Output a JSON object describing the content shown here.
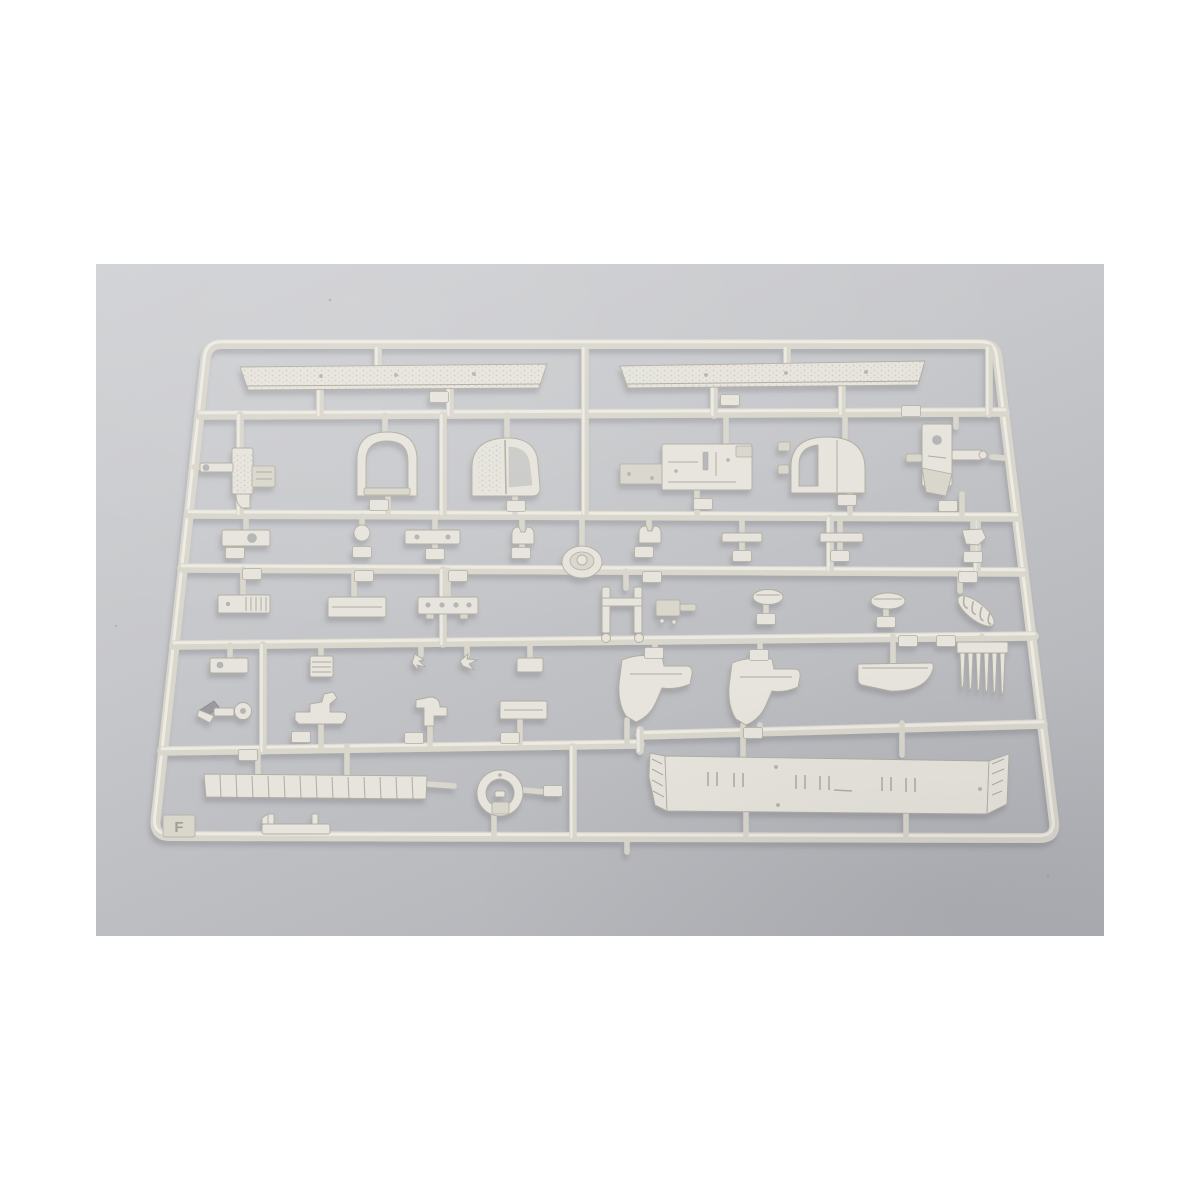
{
  "image": {
    "description": "Product photograph of an unassembled light-grey injection-molded plastic model kit sprue (runner F) holding many small parts: two long textured walkway strips, arched cockpit frames, boxed cabin structures, a winch bracket, rows of small fittings with number tags, hull-section pieces, a six-tooth comb of barrels, a ring mount, a segmented deck plank and a long flat deck plate, all laid on a neutral grey studio surface with white page margins.",
    "sprue_label": "F"
  },
  "colors": {
    "page-bg": "#ffffff",
    "photo-1": "#d0d1d4",
    "photo-2": "#c7c8cb",
    "photo-3": "#bdbec2",
    "photo-4": "#aeafb4",
    "plastic": "#d9d6cc",
    "plastic-light": "#f0eee7",
    "plastic-dark": "#b1ada1",
    "plastic-part": "#e6e4dc",
    "detail": "#a5a196",
    "hole": "#b4b5b9",
    "shadow": "#5a5a62"
  }
}
